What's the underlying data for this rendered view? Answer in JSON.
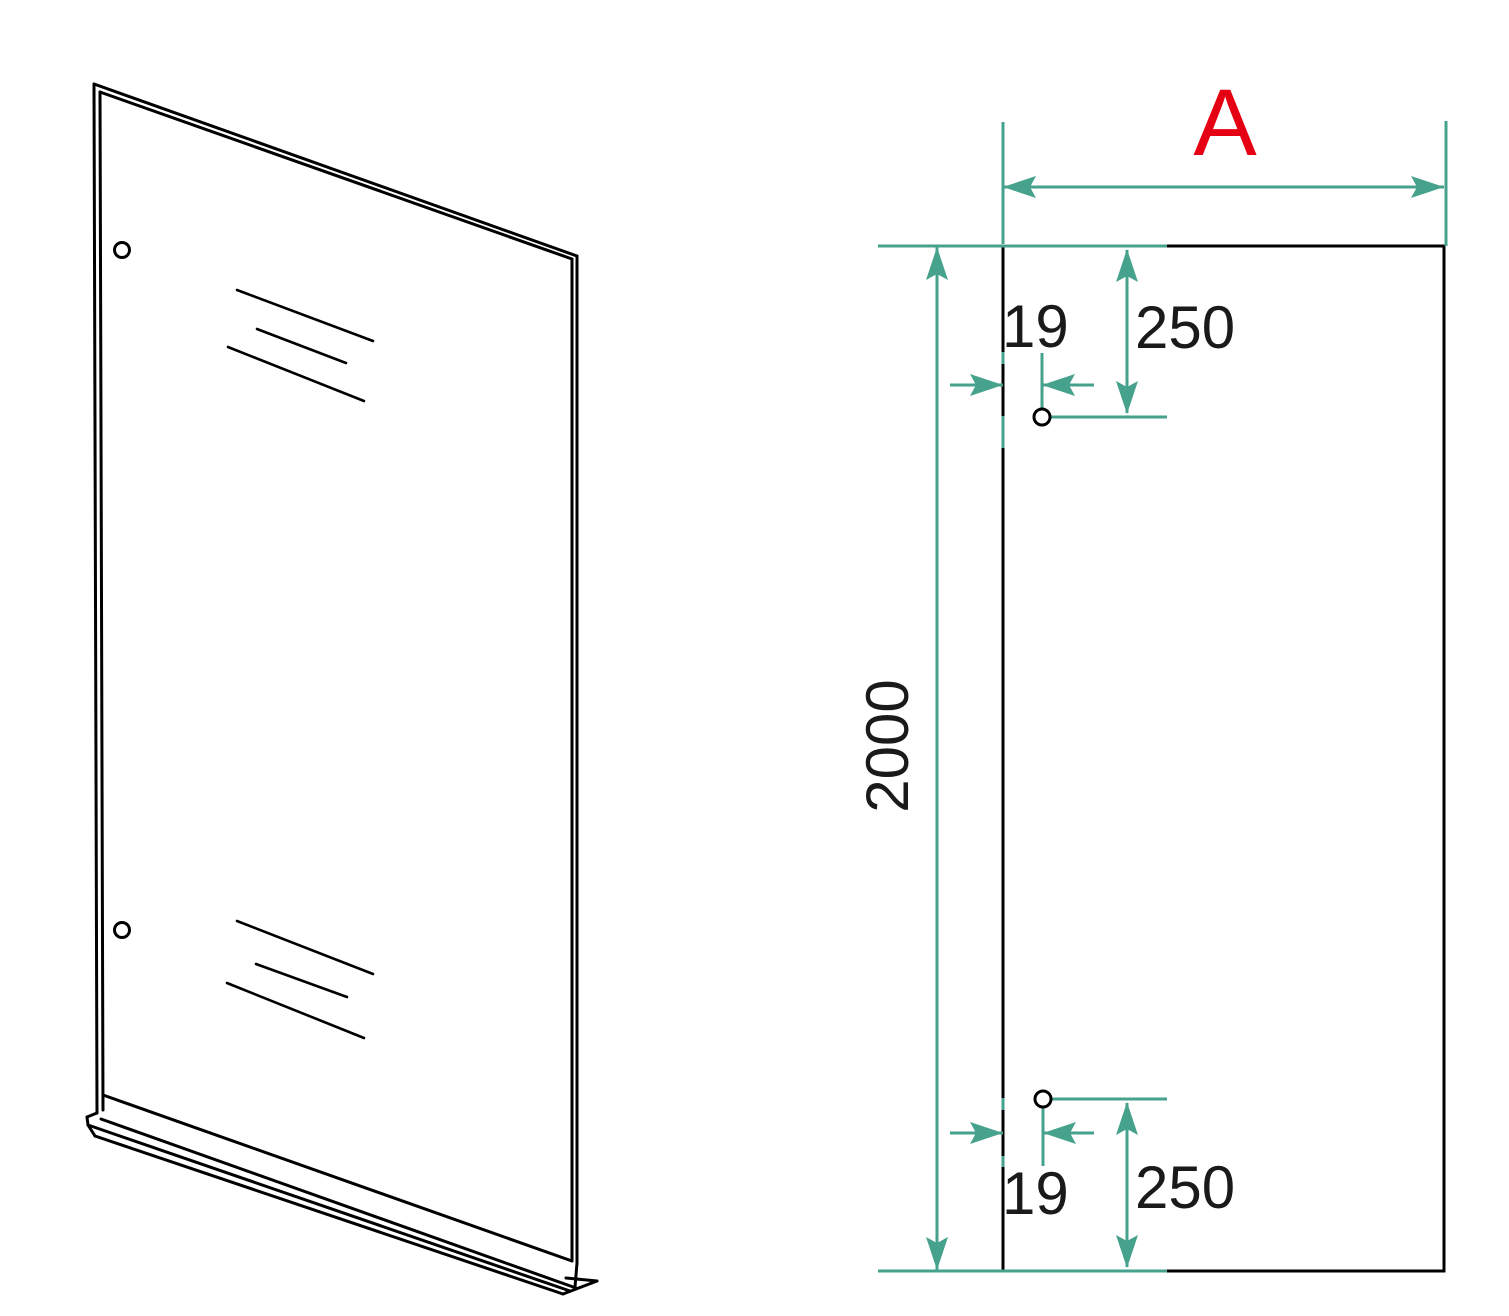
{
  "labels": {
    "width": "A",
    "height": "2000",
    "top_hole_edge_offset": "19",
    "top_hole_top_offset": "250",
    "bottom_hole_edge_offset": "19",
    "bottom_hole_bottom_offset": "250"
  },
  "colors": {
    "outline": "#000000",
    "dimension_lines": "#46a28c",
    "width_label": "#e60013",
    "background": "#ffffff"
  }
}
